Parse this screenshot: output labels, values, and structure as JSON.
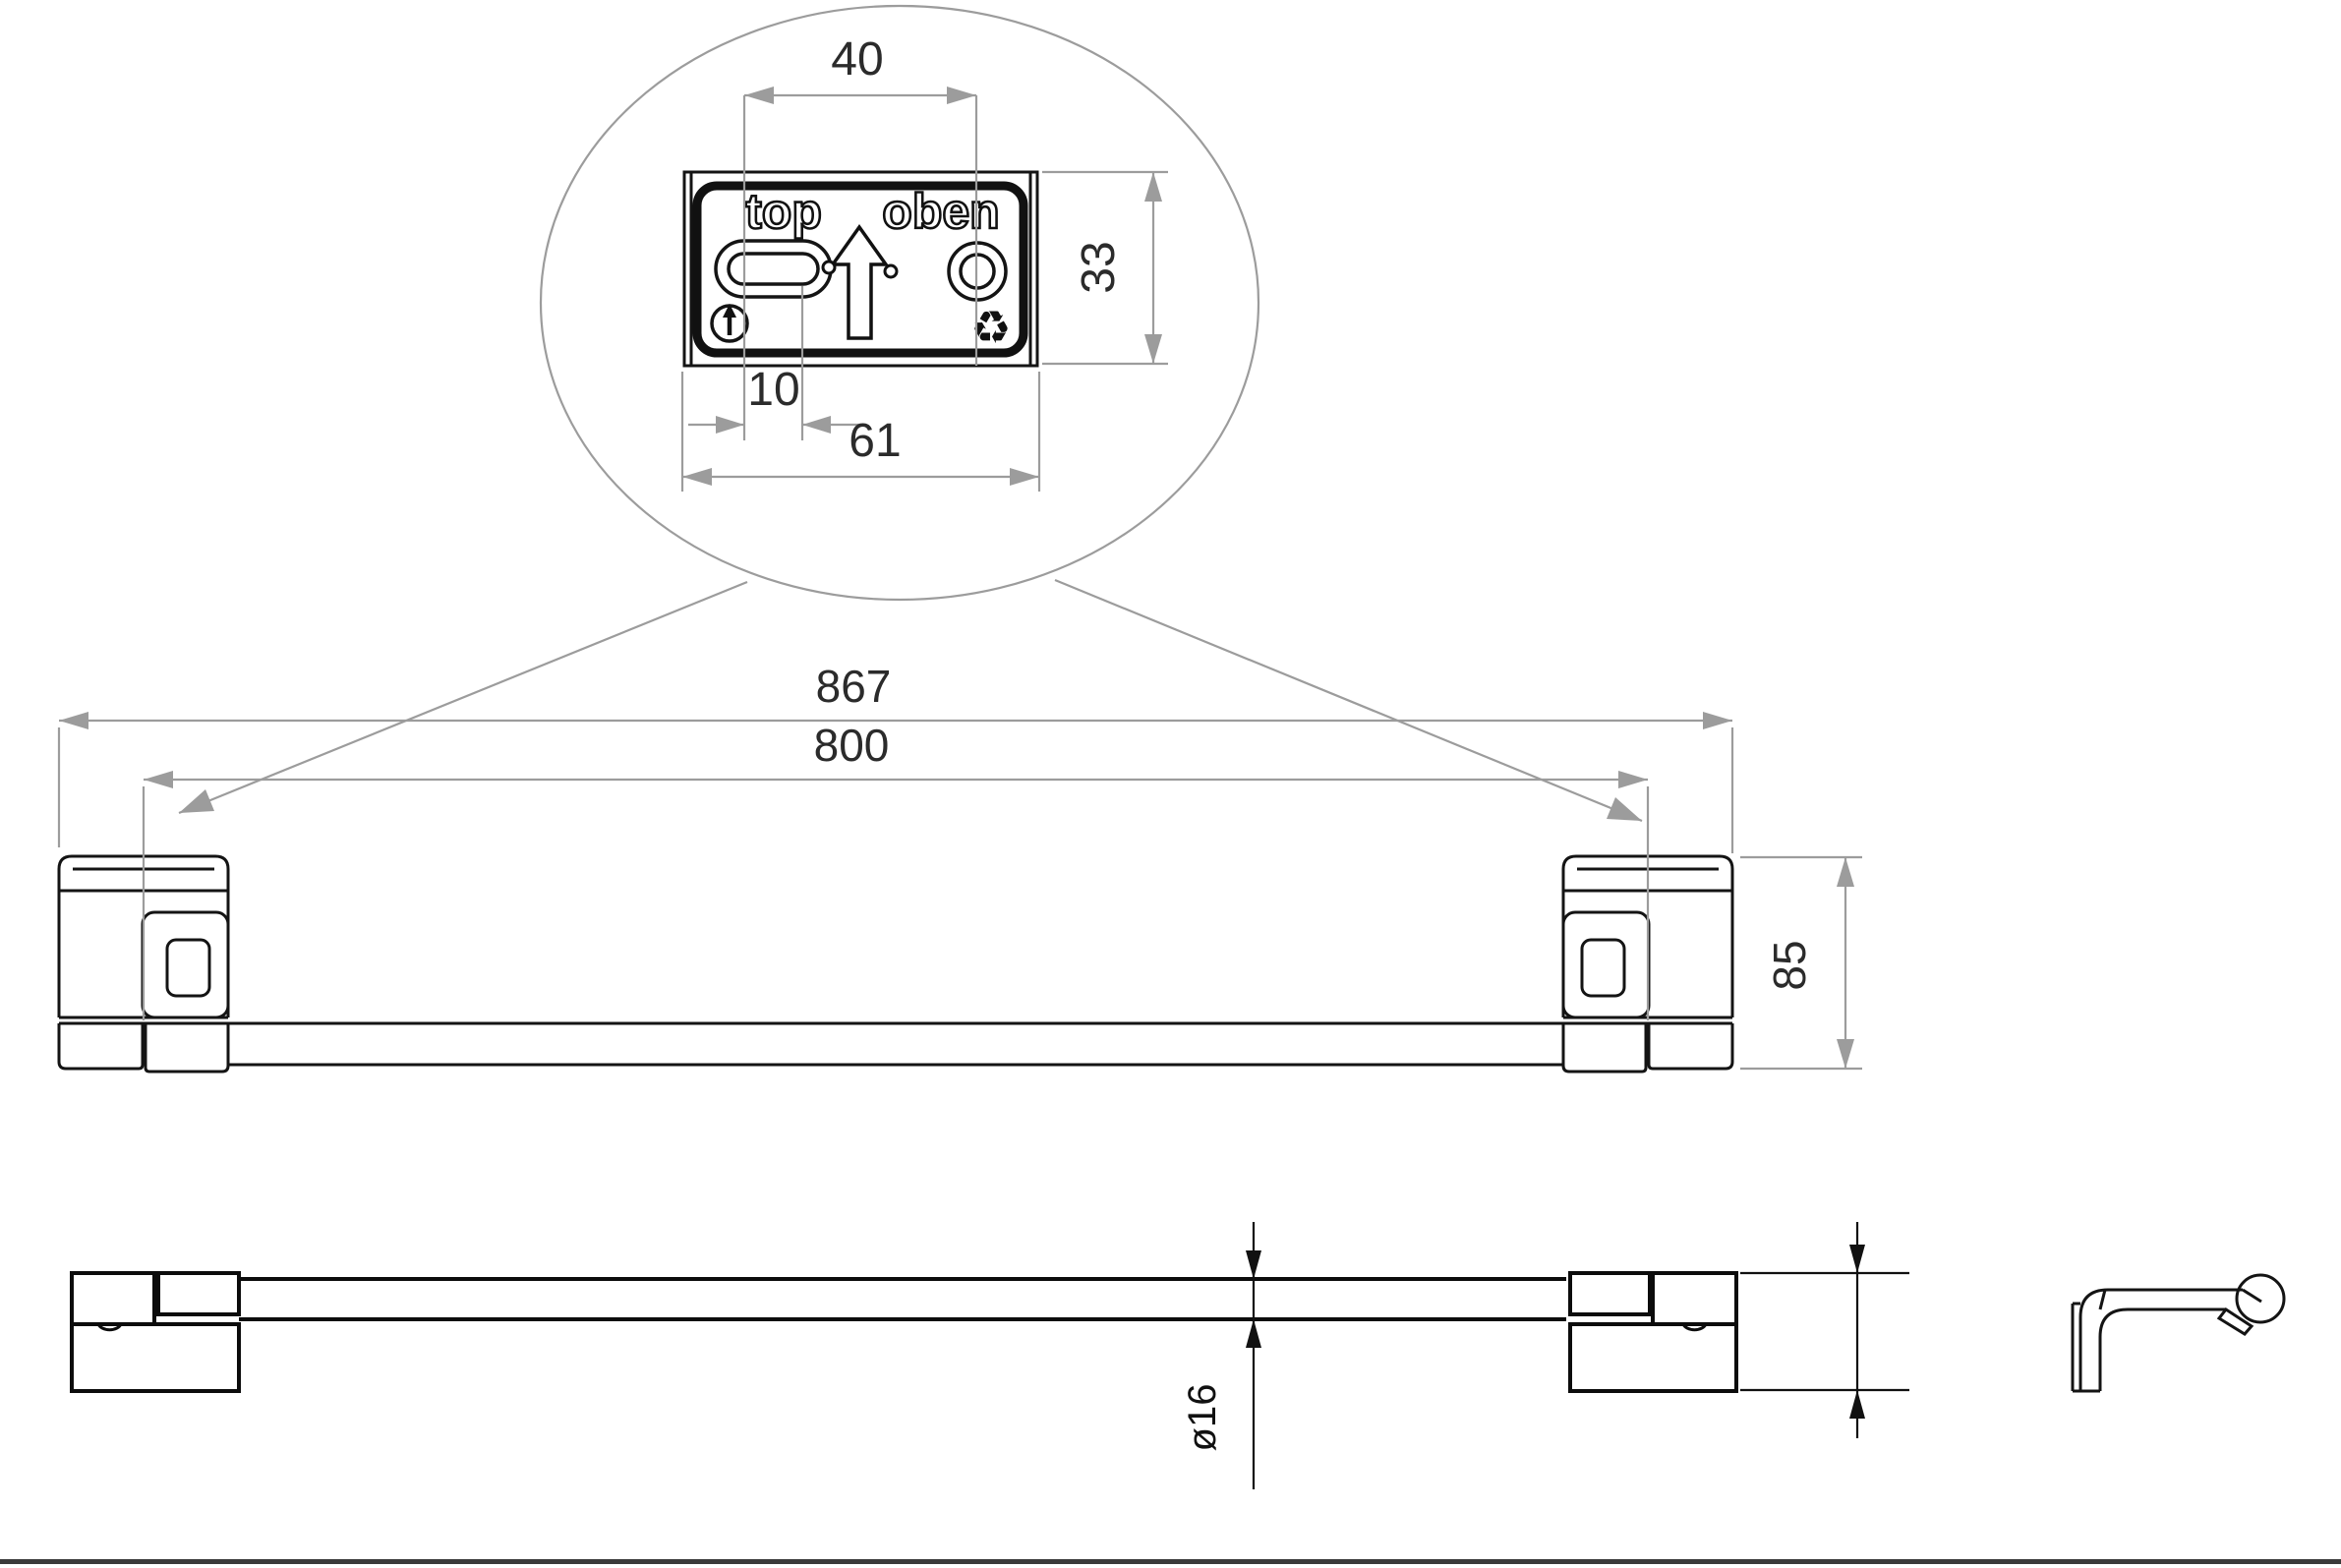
{
  "drawing": {
    "colors": {
      "outline": "#141414",
      "dimension_line": "#9c9c9c",
      "dimension_text": "#2b2b2b",
      "plan_dimension": "#111111",
      "page_border": "#3a3a3a",
      "background": "#ffffff"
    },
    "detail_view": {
      "plate_label_left": "top",
      "plate_label_right": "oben",
      "recycling_glyph": "♻",
      "dim_center_distance": "40",
      "dim_plate_height": "33",
      "dim_slot_offset": "10",
      "dim_plate_width": "61"
    },
    "front_view": {
      "dim_overall_length": "867",
      "dim_mounting_distance": "800",
      "dim_bracket_height": "85"
    },
    "plan_view": {
      "dim_bar_diameter": "ø16"
    }
  }
}
